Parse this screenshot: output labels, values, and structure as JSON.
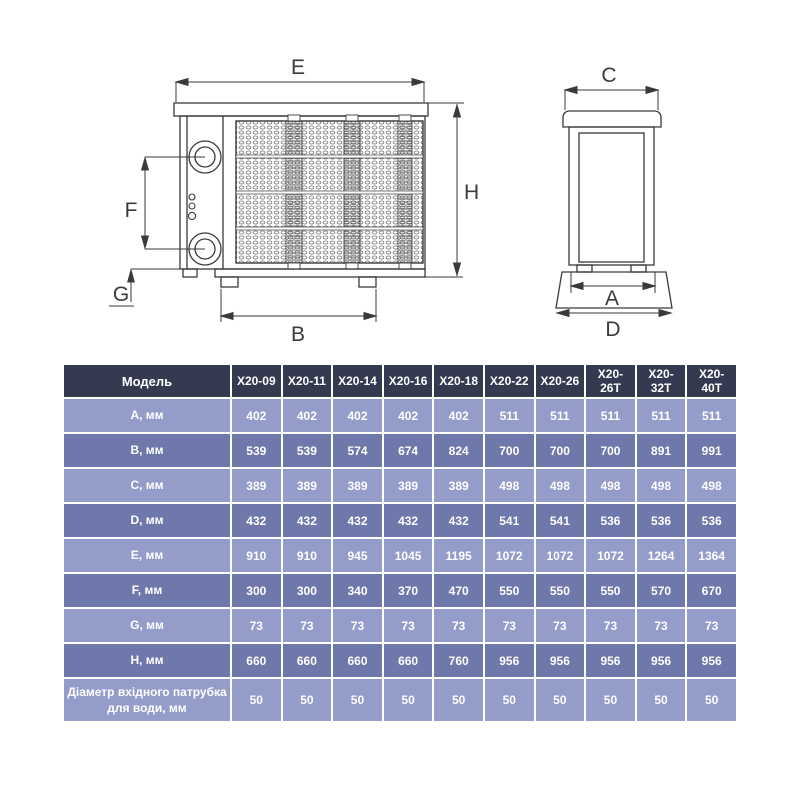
{
  "page": {
    "background": "#ffffff"
  },
  "colors": {
    "table_header_bg": "#343a4f",
    "table_row_light": "#949cca",
    "table_row_dark": "#6f78aa",
    "table_text": "#ffffff",
    "drawing_line": "#3a3a3a"
  },
  "diagram": {
    "front_view_dims": {
      "E": "E",
      "H": "H",
      "F": "F",
      "G": "G",
      "B": "B"
    },
    "side_view_dims": {
      "C": "C",
      "A": "A",
      "D": "D"
    }
  },
  "table": {
    "model_header": "Модель",
    "models": [
      "X20-09",
      "X20-11",
      "X20-14",
      "X20-16",
      "X20-18",
      "X20-22",
      "X20-26",
      "X20-26T",
      "X20-32T",
      "X20-40T"
    ],
    "rows": [
      {
        "label": "A, мм",
        "values": [
          402,
          402,
          402,
          402,
          402,
          511,
          511,
          511,
          511,
          511
        ]
      },
      {
        "label": "B, мм",
        "values": [
          539,
          539,
          574,
          674,
          824,
          700,
          700,
          700,
          891,
          991
        ]
      },
      {
        "label": "C, мм",
        "values": [
          389,
          389,
          389,
          389,
          389,
          498,
          498,
          498,
          498,
          498
        ]
      },
      {
        "label": "D, мм",
        "values": [
          432,
          432,
          432,
          432,
          432,
          541,
          541,
          536,
          536,
          536
        ]
      },
      {
        "label": "E, мм",
        "values": [
          910,
          910,
          945,
          1045,
          1195,
          1072,
          1072,
          1072,
          1264,
          1364
        ]
      },
      {
        "label": "F, мм",
        "values": [
          300,
          300,
          340,
          370,
          470,
          550,
          550,
          550,
          570,
          670
        ]
      },
      {
        "label": "G, мм",
        "values": [
          73,
          73,
          73,
          73,
          73,
          73,
          73,
          73,
          73,
          73
        ]
      },
      {
        "label": "H, мм",
        "values": [
          660,
          660,
          660,
          660,
          760,
          956,
          956,
          956,
          956,
          956
        ]
      },
      {
        "label": "Діаметр вхідного патрубка для води, мм",
        "values": [
          50,
          50,
          50,
          50,
          50,
          50,
          50,
          50,
          50,
          50
        ]
      }
    ]
  }
}
